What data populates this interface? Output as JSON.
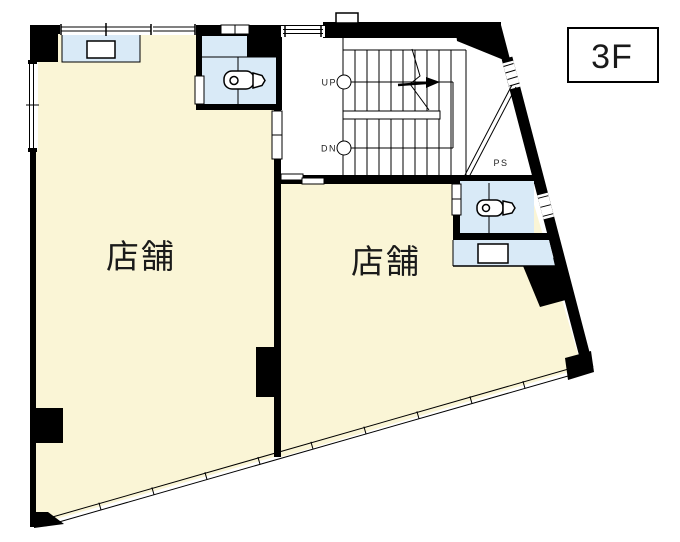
{
  "drawing": {
    "floor_label": "3F",
    "left_room_label": "店舗",
    "right_room_label": "店舗",
    "stair_up_label": "UP",
    "stair_down_label": "DN",
    "pipe_space_label": "PS"
  },
  "colors": {
    "wall": "#000000",
    "room_fill": "#FAF5D6",
    "water_fill": "#D9EAF7",
    "background": "#FFFFFF",
    "line": "#1A1A1A"
  }
}
